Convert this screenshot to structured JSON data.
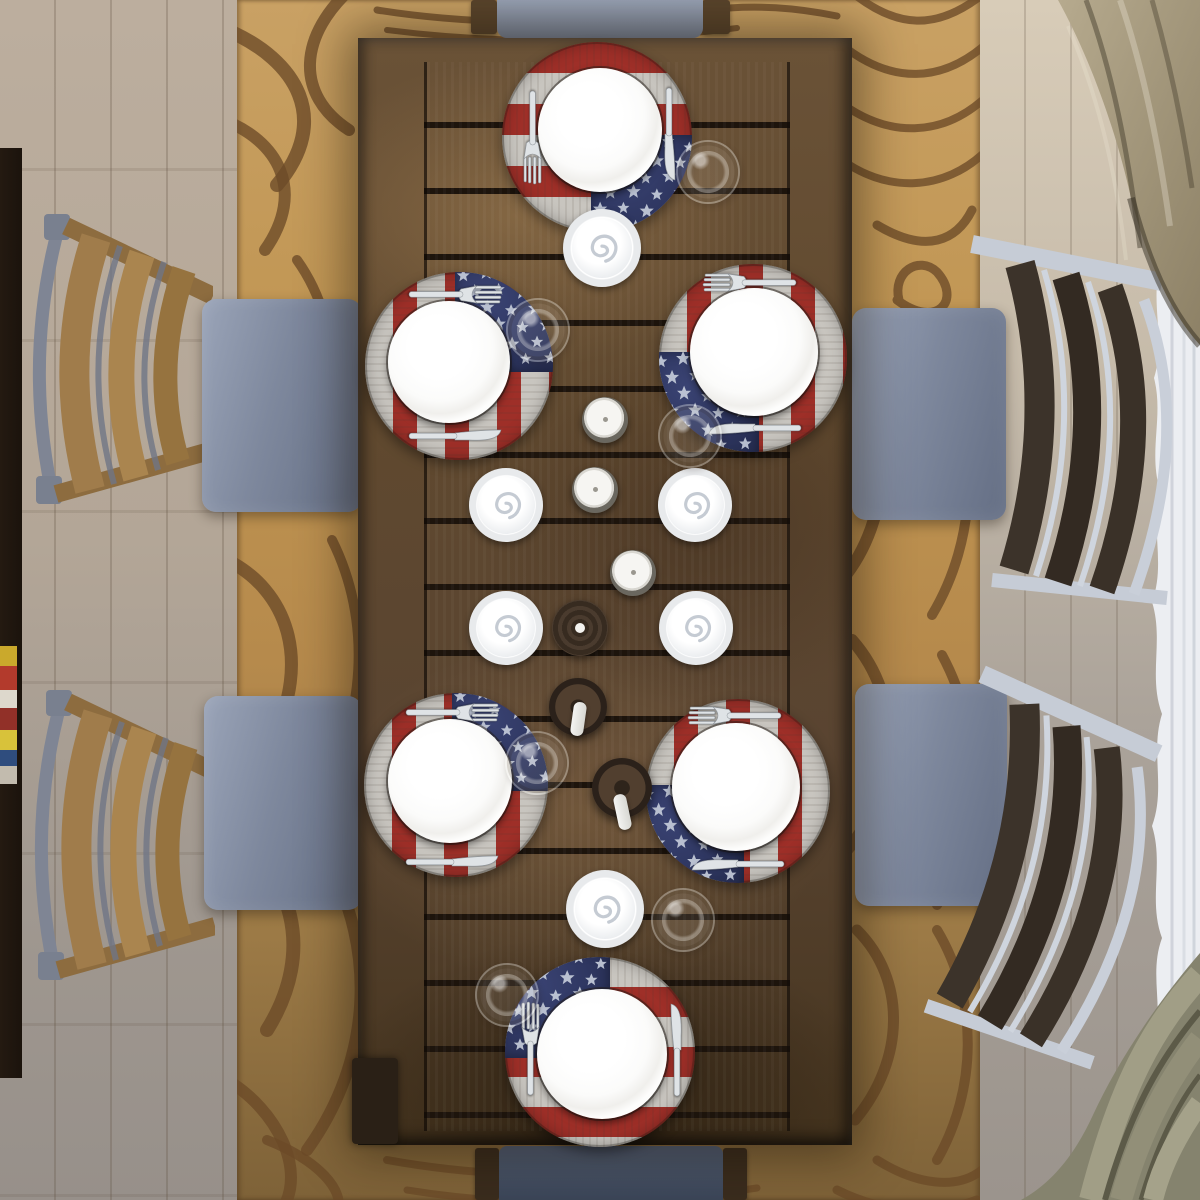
{
  "meta": {
    "scene_title": "Overhead view of a rustic plank dining table set for six with round American flag placemats, white plates, cutlery, wine glasses and candles, gray upholstered chairs on a tan swirl rug",
    "view": "top-down",
    "width": 1200,
    "height": 1200
  },
  "counts": {
    "place_settings": 6,
    "placemats": 6,
    "dinner_plates": 6,
    "forks": 6,
    "knives": 6,
    "wine_glasses": 6,
    "swirl_candles_on_saucers": 6,
    "gray_candle_jars": 3,
    "dark_wood_candle_holders": 3,
    "white_taper_candles": 2,
    "chairs_visible": 6,
    "curtains": 3
  },
  "labels": {
    "scene": "Top-down dining room scene",
    "floor": "Light wood plank floor",
    "rug": "Tan area rug with dark brown swirl pattern",
    "table": "Rustic plank wood dining table",
    "placemat": "Round weathered-wood American flag placemat",
    "flag_union": "Blue star field of flag placemat",
    "plate": "White round dinner plate",
    "fork": "Stainless steel fork",
    "knife": "Stainless steel knife",
    "glass": "Clear wine glass seen from above",
    "napkin_swirl": "White spiral candle on white saucer",
    "candle_jar": "Gray jar candle with white wax top",
    "candle_holder": "Dark wood round candle holder",
    "candle_stick": "White taper candle",
    "chair": "Dining chair with curved slat back and gray upholstered seat",
    "bench": "Upholstered bench seat at table end",
    "cabinet": "Dark sideboard edge with stacked magazines",
    "curtain_tan": "Draped tan curtain",
    "curtain_sheer": "White sheer wavy curtain",
    "curtain_khaki": "Khaki curtain folds"
  },
  "palette": {
    "floor-light": "#b8ab9c",
    "floor-dark": "#99928a",
    "rug-gold": "#c09552",
    "rug-line": "#6b4a28",
    "table-wood": "#6a5237",
    "table-gap": "#1d140c",
    "mat-red": "#9e2f28",
    "mat-silver": "#c8c5bf",
    "mat-blue": "#2e3660",
    "star": "#ccd3e0",
    "plate": "#fbfbfa",
    "metal": "#dfe3e6",
    "seat": "#7e889d",
    "seat-dark": "#4b556a",
    "chair-wood-left": "#a07c4b",
    "chair-wood-right": "#38302a",
    "curtain-tan": "#a89b7f",
    "curtain-sheer": "#eceef2",
    "curtain-khaki": "#85836e"
  },
  "placemats": [
    {
      "id": 1,
      "position": "top center",
      "center": {
        "x": 597,
        "y": 137
      },
      "stripes": "horizontal",
      "union_corner": "bottom-right",
      "fork": "left vertical, tines down",
      "knife": "right vertical, blade down"
    },
    {
      "id": 2,
      "position": "middle left",
      "center": {
        "x": 459,
        "y": 366
      },
      "stripes": "vertical",
      "union_corner": "top-right",
      "fork": "top horizontal, tines right",
      "knife": "bottom horizontal, blade right"
    },
    {
      "id": 3,
      "position": "middle right",
      "center": {
        "x": 753,
        "y": 358
      },
      "stripes": "vertical",
      "union_corner": "bottom-left",
      "fork": "top horizontal, tines left",
      "knife": "bottom horizontal, blade left"
    },
    {
      "id": 4,
      "position": "lower left",
      "center": {
        "x": 456,
        "y": 785
      },
      "stripes": "vertical",
      "union_corner": "top-right",
      "fork": "top horizontal, tines right",
      "knife": "bottom horizontal, blade right"
    },
    {
      "id": 5,
      "position": "lower right",
      "center": {
        "x": 738,
        "y": 791
      },
      "stripes": "vertical",
      "union_corner": "bottom-left",
      "fork": "top horizontal, tines left",
      "knife": "bottom horizontal, blade left"
    },
    {
      "id": 6,
      "position": "bottom center",
      "center": {
        "x": 600,
        "y": 1052
      },
      "stripes": "horizontal",
      "union_corner": "top-left",
      "fork": "left vertical, tines up",
      "knife": "right vertical, blade up"
    }
  ],
  "centerpieces": [
    {
      "type": "swirl_on_saucer",
      "x": 602,
      "y": 248
    },
    {
      "type": "gray_jar_candle",
      "x": 605,
      "y": 420
    },
    {
      "type": "gray_jar_candle",
      "x": 595,
      "y": 490
    },
    {
      "type": "swirl_on_saucer",
      "x": 506,
      "y": 505
    },
    {
      "type": "swirl_on_saucer",
      "x": 695,
      "y": 505
    },
    {
      "type": "gray_jar_candle",
      "x": 633,
      "y": 573
    },
    {
      "type": "swirl_on_saucer",
      "x": 506,
      "y": 628
    },
    {
      "type": "swirl_on_saucer",
      "x": 696,
      "y": 628
    },
    {
      "type": "wood_holder",
      "x": 580,
      "y": 628
    },
    {
      "type": "wood_holder_with_candle",
      "x": 578,
      "y": 707
    },
    {
      "type": "wood_holder_with_candle",
      "x": 622,
      "y": 788
    },
    {
      "type": "swirl_on_saucer",
      "x": 605,
      "y": 909
    }
  ],
  "glasses": [
    {
      "x": 708,
      "y": 172
    },
    {
      "x": 538,
      "y": 330
    },
    {
      "x": 690,
      "y": 436
    },
    {
      "x": 537,
      "y": 763
    },
    {
      "x": 683,
      "y": 920
    },
    {
      "x": 507,
      "y": 995
    }
  ]
}
